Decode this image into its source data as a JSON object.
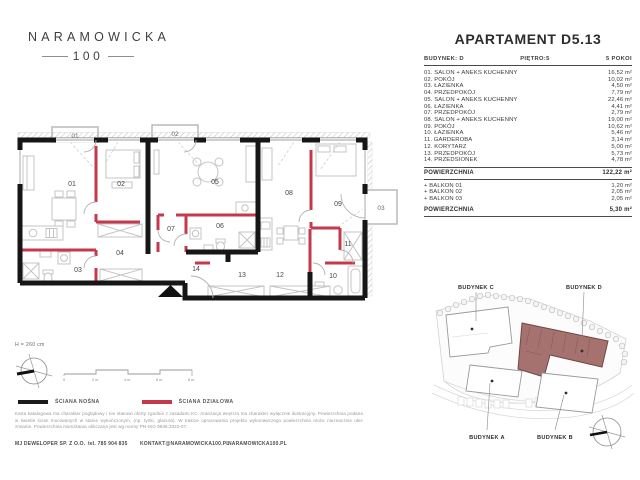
{
  "brand": {
    "name": "NARAMOWICKA",
    "number": "100"
  },
  "header": {
    "title": "APARTAMENT D5.13",
    "building": "BUDYNEK: D",
    "floor": "PIĘTRO:5",
    "rooms": "5 POKOI"
  },
  "room_list": [
    {
      "label": "01. SALON + ANEKS KUCHENNY",
      "area": "16,52 m²"
    },
    {
      "label": "02. POKÓJ",
      "area": "10,02 m²"
    },
    {
      "label": "03. ŁAZIENKA",
      "area": "4,50 m²"
    },
    {
      "label": "04. PRZEDPOKÓJ",
      "area": "7,79 m²"
    },
    {
      "label": "05. SALON + ANEKS KUCHENNY",
      "area": "22,46 m²"
    },
    {
      "label": "06. ŁAZIENKA",
      "area": "4,41 m²"
    },
    {
      "label": "07. PRZEDPOKÓJ",
      "area": "2,79 m²"
    },
    {
      "label": "08. SALON + ANEKS KUCHENNY",
      "area": "19,00 m²"
    },
    {
      "label": "09. POKÓJ",
      "area": "10,62 m²"
    },
    {
      "label": "10. ŁAZIENKA",
      "area": "5,46 m²"
    },
    {
      "label": "11. GARDEROBA",
      "area": "3,14 m²"
    },
    {
      "label": "12. KORYTARZ",
      "area": "5,00 m²"
    },
    {
      "label": "13. PRZEDPOKÓJ",
      "area": "5,73 m²"
    },
    {
      "label": "14. PRZEDSIONEK",
      "area": "4,78 m²"
    }
  ],
  "total": {
    "label": "POWIERZCHNIA",
    "value": "122,22 m²"
  },
  "balconies": [
    {
      "label": "+ BALKON 01",
      "area": "1,20 m²"
    },
    {
      "label": "+ BALKON 02",
      "area": "2,05 m²"
    },
    {
      "label": "+ BALKON 03",
      "area": "2,05 m²"
    }
  ],
  "balcony_total": {
    "label": "POWIERZCHNIA",
    "value": "5,30 m²"
  },
  "plan": {
    "height_note": "H = 260 cm",
    "rooms": {
      "n01": "01",
      "n02": "02",
      "n03": "03",
      "n04": "04",
      "n05": "05",
      "n06": "06",
      "n07": "07",
      "n08": "08",
      "n09": "09",
      "n10": "10",
      "n11": "11",
      "n12": "12",
      "n13": "13",
      "n14": "14"
    },
    "balcony_labels": {
      "b01": "01",
      "b02": "02",
      "b03": "03"
    },
    "scale_ticks": [
      "0",
      "2 m",
      "4 m",
      "6 m",
      "8 m"
    ],
    "colors": {
      "load_bearing": "#161616",
      "partition": "#c5394d"
    }
  },
  "legend": {
    "load_bearing": "ŚCIANA NOŚNA",
    "partition": "ŚCIANA DZIAŁOWA"
  },
  "site": {
    "buildings": [
      {
        "label": "BUDYNEK C"
      },
      {
        "label": "BUDYNEK D"
      },
      {
        "label": "BUDYNEK A"
      },
      {
        "label": "BUDYNEK B"
      }
    ],
    "highlight_color": "#a57270"
  },
  "disclaimer": "Karta katalogowa ma charakter poglądowy i nie stanowi oferty zgodnie z zasadami KC. Aranżacja wnętrza ma charakter wyłącznie ilustracyjny. Powierzchnia podana w świetle ścian murowanych w stanie wykończonym, (np. tynki, glazura). W trakcie opracowania projektu wykonawczego powierzchnia może nieznacznie ulec zmianie. Powierzchnia mieszkania obliczana jest wg normy PN-ISO 9836:2022-07.",
  "footer": {
    "company": "MJ DEWELOPER SP. Z O.O.",
    "phone": "tel. 785 904 835",
    "email": "KONTAKT@NARAMOWICKA100.PL",
    "website": "NARAMOWICKA100.PL"
  }
}
